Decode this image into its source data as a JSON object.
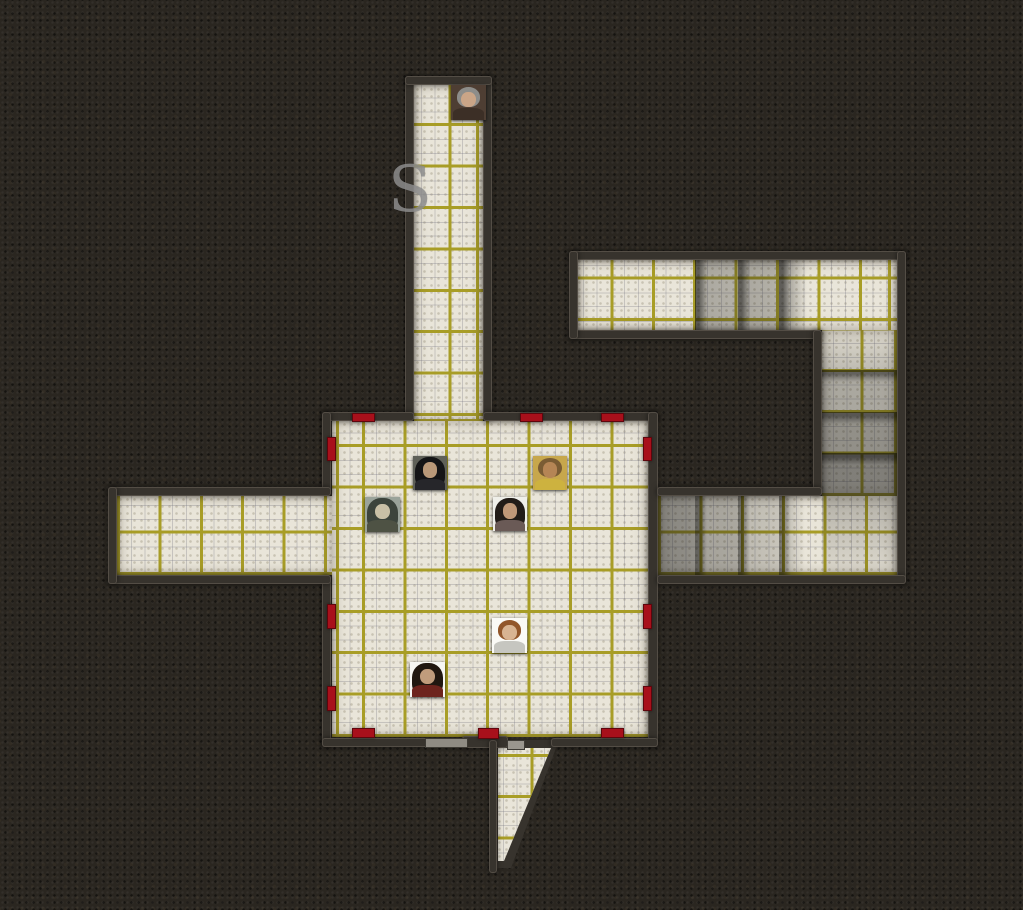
{
  "map": {
    "marking": {
      "text": "S",
      "x": 388,
      "y": 158,
      "size": 64,
      "color": "#8c8c8c"
    },
    "palette": {
      "background": "#2a2620",
      "floor": "#e9e5d9",
      "grid": "#a89d26",
      "wall": "#37332d",
      "door_red": "#a8101b"
    },
    "areas": [
      {
        "name": "top-corridor",
        "x": 414,
        "y": 84,
        "w": 69,
        "h": 337,
        "gx": -7,
        "gy": -5
      },
      {
        "name": "central-room",
        "x": 332,
        "y": 421,
        "w": 316,
        "h": 316,
        "gx": 30,
        "gy": 0
      },
      {
        "name": "left-corridor",
        "x": 117,
        "y": 496,
        "w": 215,
        "h": 79,
        "gx": 0,
        "gy": 0
      },
      {
        "name": "top-right-corridor",
        "x": 578,
        "y": 260,
        "w": 319,
        "h": 70,
        "gx": -9,
        "gy": -9
      },
      {
        "name": "right-corridor",
        "x": 822,
        "y": 330,
        "w": 75,
        "h": 166,
        "gx": -3,
        "gy": 0
      },
      {
        "name": "mid-right-corridor",
        "x": 658,
        "y": 496,
        "w": 239,
        "h": 79,
        "gx": 0,
        "gy": 0
      }
    ],
    "passage": {
      "name": "bottom-passage",
      "x": 489,
      "y": 740,
      "w": 70,
      "h": 133,
      "dark_clip": "polygon(0px 0px, 70px 0px, 22px 128px, 0px 128px)",
      "floor_clip": "polygon(9px 8px, 62px 8px, 15px 121px, 9px 121px)",
      "gx": 0,
      "gy": 8
    },
    "walls": [
      {
        "name": "top-corridor-left",
        "x": 405,
        "y": 76,
        "w": 9,
        "h": 345
      },
      {
        "name": "top-corridor-right",
        "x": 483,
        "y": 76,
        "w": 9,
        "h": 345
      },
      {
        "name": "top-corridor-cap",
        "x": 405,
        "y": 76,
        "w": 87,
        "h": 9
      },
      {
        "name": "room-top-left",
        "x": 322,
        "y": 412,
        "w": 92,
        "h": 9
      },
      {
        "name": "room-top-right",
        "x": 483,
        "y": 412,
        "w": 175,
        "h": 9
      },
      {
        "name": "room-left-upper",
        "x": 322,
        "y": 412,
        "w": 9,
        "h": 84
      },
      {
        "name": "room-left-lower",
        "x": 322,
        "y": 575,
        "w": 9,
        "h": 172
      },
      {
        "name": "room-right",
        "x": 648,
        "y": 412,
        "w": 10,
        "h": 335
      },
      {
        "name": "room-bottom-left",
        "x": 322,
        "y": 738,
        "w": 146,
        "h": 9
      },
      {
        "name": "room-bottom-mid",
        "x": 462,
        "y": 736,
        "w": 46,
        "h": 12
      },
      {
        "name": "room-bottom-right",
        "x": 551,
        "y": 738,
        "w": 107,
        "h": 9
      },
      {
        "name": "left-corridor-top",
        "x": 108,
        "y": 487,
        "w": 223,
        "h": 9
      },
      {
        "name": "left-corridor-bottom",
        "x": 108,
        "y": 575,
        "w": 223,
        "h": 9
      },
      {
        "name": "left-corridor-cap",
        "x": 108,
        "y": 487,
        "w": 9,
        "h": 97
      },
      {
        "name": "tr-corridor-top",
        "x": 569,
        "y": 251,
        "w": 337,
        "h": 9
      },
      {
        "name": "tr-corridor-bottom",
        "x": 569,
        "y": 330,
        "w": 253,
        "h": 9
      },
      {
        "name": "tr-corridor-cap",
        "x": 569,
        "y": 251,
        "w": 9,
        "h": 88
      },
      {
        "name": "right-corridor-right",
        "x": 897,
        "y": 251,
        "w": 9,
        "h": 333
      },
      {
        "name": "right-corridor-left",
        "x": 813,
        "y": 330,
        "w": 9,
        "h": 166
      },
      {
        "name": "mr-corridor-top",
        "x": 657,
        "y": 487,
        "w": 165,
        "h": 9
      },
      {
        "name": "mr-corridor-bottom",
        "x": 657,
        "y": 575,
        "w": 249,
        "h": 9
      },
      {
        "name": "passage-left-wall",
        "x": 489,
        "y": 740,
        "w": 8,
        "h": 133
      }
    ],
    "doors": [
      {
        "name": "door-room-top-1",
        "x": 352,
        "y": 413,
        "w": 23,
        "h": 9
      },
      {
        "name": "door-room-top-2",
        "x": 520,
        "y": 413,
        "w": 23,
        "h": 9
      },
      {
        "name": "door-room-top-3",
        "x": 601,
        "y": 413,
        "w": 23,
        "h": 9
      },
      {
        "name": "door-room-left-1",
        "x": 327,
        "y": 437,
        "w": 9,
        "h": 24
      },
      {
        "name": "door-room-left-2",
        "x": 327,
        "y": 604,
        "w": 9,
        "h": 25
      },
      {
        "name": "door-room-left-3",
        "x": 327,
        "y": 686,
        "w": 9,
        "h": 25
      },
      {
        "name": "door-room-right-1",
        "x": 643,
        "y": 437,
        "w": 9,
        "h": 24
      },
      {
        "name": "door-room-right-2",
        "x": 643,
        "y": 604,
        "w": 9,
        "h": 25
      },
      {
        "name": "door-room-right-3",
        "x": 643,
        "y": 686,
        "w": 9,
        "h": 25
      },
      {
        "name": "door-room-bottom-1",
        "x": 352,
        "y": 728,
        "w": 23,
        "h": 10
      },
      {
        "name": "door-room-bottom-2",
        "x": 478,
        "y": 728,
        "w": 21,
        "h": 11
      },
      {
        "name": "door-room-bottom-3",
        "x": 601,
        "y": 728,
        "w": 23,
        "h": 10
      }
    ],
    "gray_doors": [
      {
        "name": "gray-door-1",
        "x": 425,
        "y": 738,
        "w": 43,
        "h": 10,
        "c": "#8f8b83"
      },
      {
        "name": "gray-door-2",
        "x": 507,
        "y": 740,
        "w": 18,
        "h": 10,
        "c": "#9a968e"
      }
    ],
    "shadows": [
      {
        "x": 695,
        "y": 260,
        "w": 43,
        "h": 70,
        "css": "linear-gradient(90deg, rgba(10,10,10,.62) 0px, rgba(10,10,10,.62) 4px, rgba(30,30,30,.30) 12px, rgba(30,30,30,.26) 100%)"
      },
      {
        "x": 738,
        "y": 260,
        "w": 41,
        "h": 70,
        "css": "linear-gradient(90deg, rgba(10,10,10,.62) 0px, rgba(10,10,10,.62) 4px, rgba(30,30,30,.30) 12px, rgba(30,30,30,.26) 100%)"
      },
      {
        "x": 779,
        "y": 260,
        "w": 28,
        "h": 70,
        "css": "linear-gradient(90deg, rgba(10,10,10,.62) 0px, rgba(10,10,10,.62) 4px, rgba(30,30,30,.28) 12px, rgba(30,30,30,0) 100%)"
      },
      {
        "x": 822,
        "y": 330,
        "w": 75,
        "h": 40,
        "css": "linear-gradient(180deg, rgba(20,20,20,.05), rgba(20,20,20,.2))"
      },
      {
        "x": 822,
        "y": 370,
        "w": 75,
        "h": 42,
        "css": "linear-gradient(180deg, rgba(10,10,10,.6) 0px, rgba(10,10,10,.6) 4px, rgba(25,25,25,.3) 12px, rgba(25,25,25,.3) 100%)"
      },
      {
        "x": 822,
        "y": 412,
        "w": 75,
        "h": 41,
        "css": "linear-gradient(180deg, rgba(10,10,10,.65) 0px, rgba(10,10,10,.65) 4px, rgba(25,25,25,.42) 12px, rgba(25,25,25,.42) 100%)"
      },
      {
        "x": 822,
        "y": 453,
        "w": 75,
        "h": 43,
        "css": "linear-gradient(180deg, rgba(10,10,10,.7) 0px, rgba(10,10,10,.7) 4px, rgba(25,25,25,.5) 12px, rgba(25,25,25,.5) 100%)"
      },
      {
        "x": 658,
        "y": 496,
        "w": 37,
        "h": 79,
        "css": "linear-gradient(90deg, rgba(25,25,25,.48), rgba(25,25,25,.42))"
      },
      {
        "x": 695,
        "y": 496,
        "w": 43,
        "h": 79,
        "css": "linear-gradient(90deg, rgba(10,10,10,.6) 0px, rgba(10,10,10,.6) 4px, rgba(25,25,25,.32) 12px, rgba(25,25,25,.3) 100%)"
      },
      {
        "x": 738,
        "y": 496,
        "w": 41,
        "h": 79,
        "css": "linear-gradient(90deg, rgba(10,10,10,.55) 0px, rgba(10,10,10,.55) 4px, rgba(25,25,25,.2) 12px, rgba(25,25,25,.16) 100%)"
      },
      {
        "x": 779,
        "y": 496,
        "w": 26,
        "h": 79,
        "css": "linear-gradient(90deg, rgba(10,10,10,.5) 0px, rgba(10,10,10,.5) 4px, rgba(25,25,25,.15) 12px, rgba(25,25,25,0) 100%)"
      },
      {
        "x": 822,
        "y": 496,
        "w": 75,
        "h": 79,
        "css": "linear-gradient(180deg, rgba(20,20,20,.25), rgba(20,20,20,.05))"
      }
    ],
    "tokens": [
      {
        "name": "bald-elder",
        "x": 451,
        "y": 85,
        "s": 35,
        "bg": "#4e3e33",
        "hair": "#8d8d8a",
        "face": "#caa587",
        "body": "#3c2f26",
        "long": false
      },
      {
        "name": "dark-haired-warrior",
        "x": 413,
        "y": 456,
        "s": 34,
        "bg": "#5f6058",
        "hair": "#141416",
        "face": "#b99878",
        "body": "#26262a",
        "long": true
      },
      {
        "name": "gold-clad-bearded",
        "x": 533,
        "y": 456,
        "s": 34,
        "bg": "#c7a74c",
        "hair": "#7a5c34",
        "face": "#b58555",
        "body": "#cdb23f",
        "long": false
      },
      {
        "name": "wild-barbarian",
        "x": 365,
        "y": 497,
        "s": 35,
        "bg": "#9aa39a",
        "hair": "#3c443c",
        "face": "#c8c0a6",
        "body": "#4e5244",
        "long": true
      },
      {
        "name": "dark-haired-woman",
        "x": 493,
        "y": 497,
        "s": 34,
        "bg": "#efefe9",
        "hair": "#221c18",
        "face": "#c09878",
        "body": "#6a5a56",
        "long": true
      },
      {
        "name": "brown-haired-youth",
        "x": 492,
        "y": 618,
        "s": 35,
        "bg": "#fafaf6",
        "hair": "#91562a",
        "face": "#d8b492",
        "body": "#c6c6c0",
        "long": false
      },
      {
        "name": "maroon-clad-man",
        "x": 410,
        "y": 662,
        "s": 35,
        "bg": "#f6f6f2",
        "hair": "#201710",
        "face": "#c09c7c",
        "body": "#6d241d",
        "long": true
      }
    ]
  }
}
